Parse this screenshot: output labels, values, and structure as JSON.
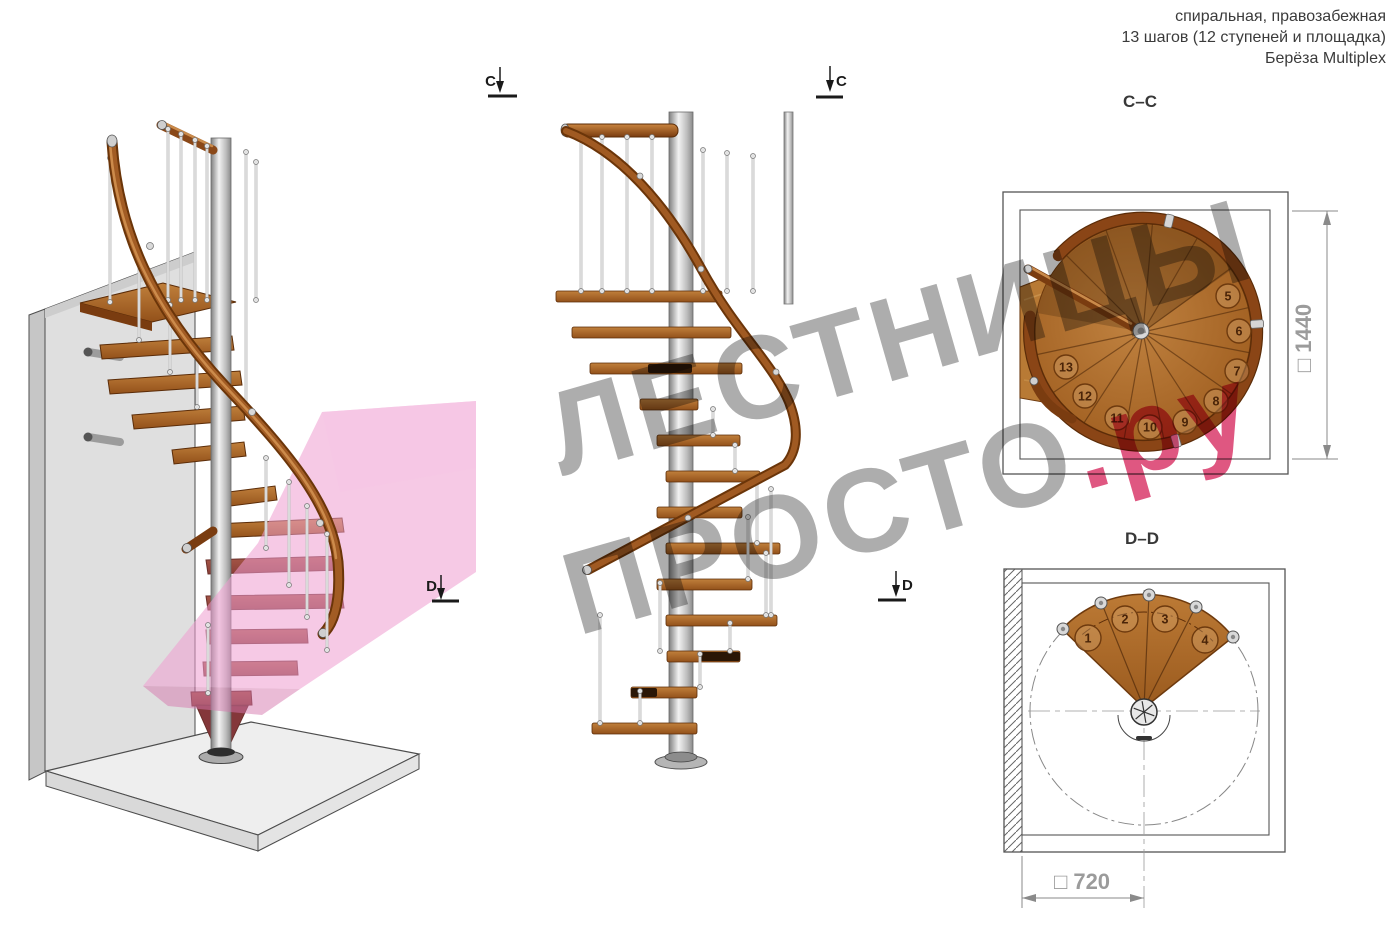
{
  "header": {
    "line1": "спиральная, правозабежная",
    "line2": "13 шагов (12 ступеней и площадка)",
    "line3": "Берёза Multiplex"
  },
  "watermark": {
    "line1": "ЛЕСТНИЦЫ",
    "line2_gray": "ПРОСТО",
    "line2_red": ".ру",
    "gray_color": "#a6a6a6",
    "red_color": "#dd4876"
  },
  "section_markers": {
    "c": "C",
    "d": "D"
  },
  "plan_cc": {
    "title": "C–C",
    "dimension_label": "□ 1440",
    "badge_radius": 12,
    "steps": [
      {
        "label": "5",
        "x": 1228,
        "y": 296
      },
      {
        "label": "6",
        "x": 1239,
        "y": 331
      },
      {
        "label": "7",
        "x": 1237,
        "y": 371
      },
      {
        "label": "8",
        "x": 1216,
        "y": 401
      },
      {
        "label": "9",
        "x": 1185,
        "y": 422
      },
      {
        "label": "10",
        "x": 1150,
        "y": 427
      },
      {
        "label": "11",
        "x": 1117,
        "y": 418
      },
      {
        "label": "12",
        "x": 1085,
        "y": 396
      },
      {
        "label": "13",
        "x": 1066,
        "y": 367
      }
    ]
  },
  "plan_dd": {
    "title": "D–D",
    "dimension_label": "□ 720",
    "badge_radius": 13,
    "steps": [
      {
        "label": "1",
        "x": 1088,
        "y": 638
      },
      {
        "label": "2",
        "x": 1125,
        "y": 619
      },
      {
        "label": "3",
        "x": 1165,
        "y": 619
      },
      {
        "label": "4",
        "x": 1205,
        "y": 640
      }
    ]
  },
  "colors": {
    "wood": "#a96420",
    "rail": "#7a3c10",
    "metal": "#c9c9c9",
    "section_plane_pink": "#f0a8d0",
    "dimension_gray": "#9b9b9b",
    "watermark_gray": "#a6a6a6",
    "watermark_red": "#dd4876"
  }
}
